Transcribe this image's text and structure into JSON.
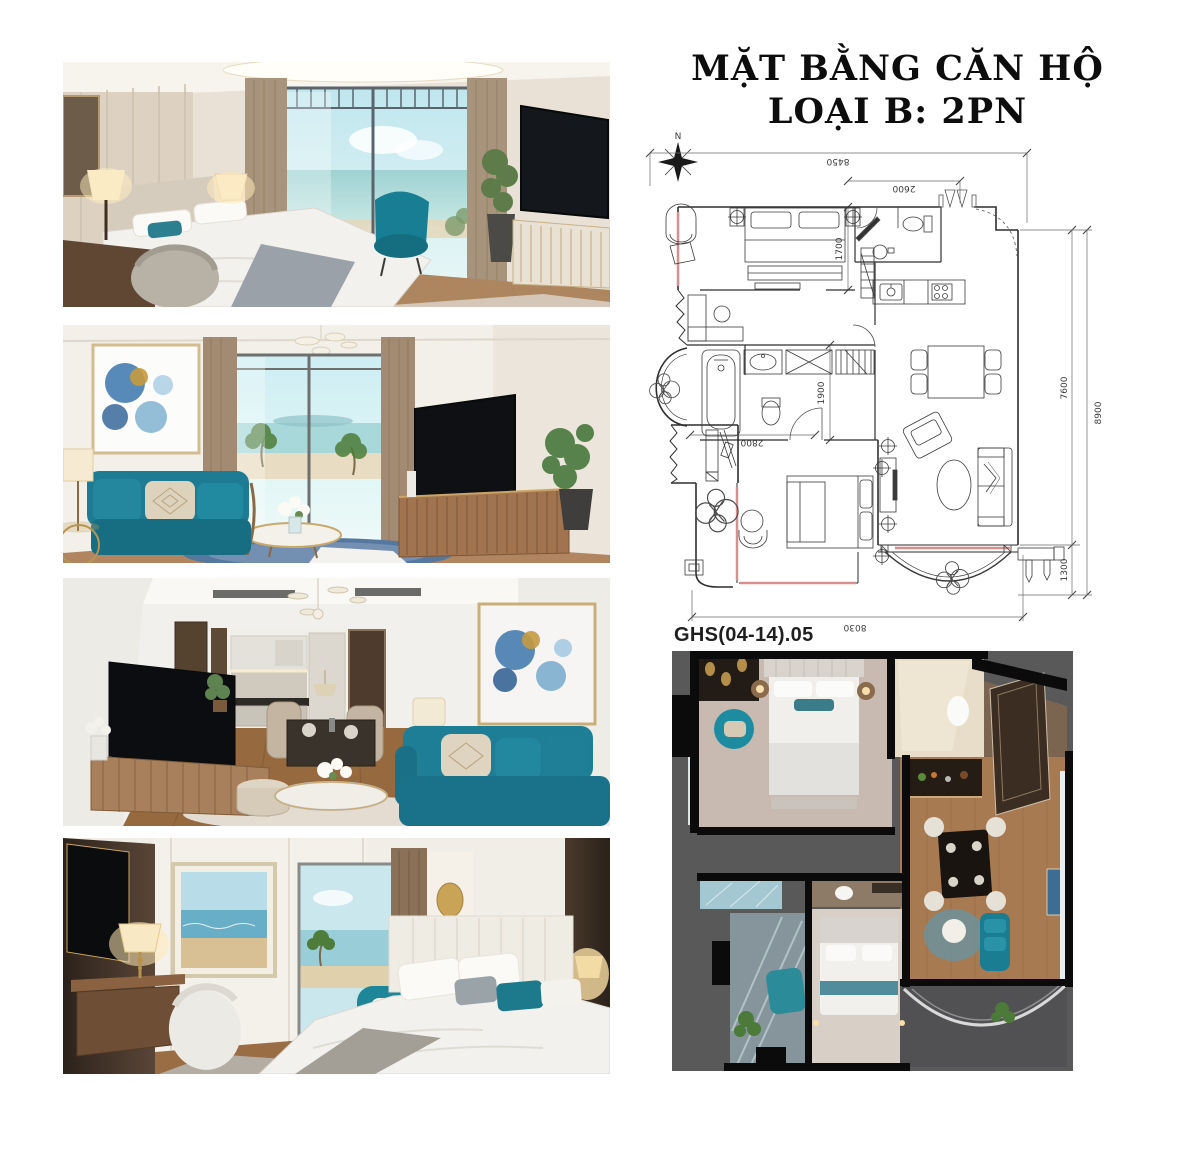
{
  "page": {
    "background": "#ffffff"
  },
  "header": {
    "title_line1": "MẶT BẰNG CĂN HỘ",
    "title_line2": "LOẠI B: 2PN"
  },
  "floor_plan": {
    "drawing_code": "GHS(04-14).05",
    "compass": {
      "north_label": "N"
    },
    "dimensions": {
      "top_overall": "8450",
      "top_secondary": "2600",
      "inner_top_vertical": "1700",
      "inner_mid_vertical": "1900",
      "inner_bottom_horizontal": "2800",
      "right_inner": "7600",
      "right_overall": "8900",
      "right_balcony": "1300",
      "bottom_overall": "8030"
    },
    "colors": {
      "line": "#3b3b3b",
      "window_highlight": "#d98f8f"
    }
  },
  "photos": [
    {
      "name": "bedroom-sea-view"
    },
    {
      "name": "living-room-teal-sofa"
    },
    {
      "name": "living-dining-kitchen"
    },
    {
      "name": "second-bedroom"
    }
  ],
  "render_3d": {
    "name": "apartment-3d-top-view",
    "background": "#59595a"
  },
  "accent_colors": {
    "teal": "#1f7f95",
    "wood": "#a87a52"
  }
}
